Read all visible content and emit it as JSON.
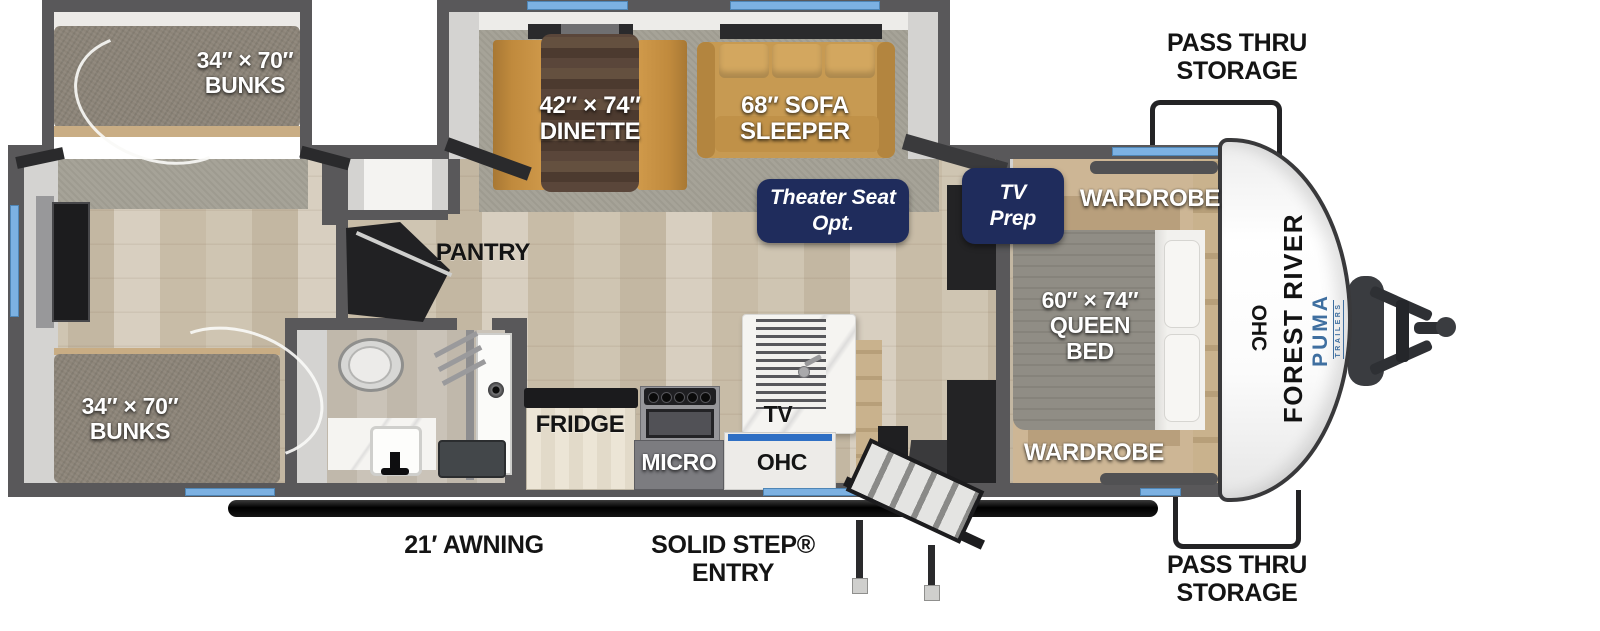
{
  "title": "Forest River Puma travel trailer floor plan",
  "colors": {
    "badge_navy": "#1f2c5c",
    "window_blue": "#7cb1e2",
    "puma_blue": "#3f6fa0",
    "wall_gray": "#59585a"
  },
  "exterior": {
    "pass_thru_top": {
      "line1": "PASS THRU",
      "line2": "STORAGE"
    },
    "pass_thru_bottom": {
      "line1": "PASS THRU",
      "line2": "STORAGE"
    },
    "awning": "21′ AWNING",
    "entry": {
      "line1": "SOLID STEP®",
      "line2": "ENTRY"
    },
    "brand_vertical": "FOREST RIVER",
    "model_vertical": "PUMA",
    "model_sub": "TRAILERS"
  },
  "rooms": {
    "bunk_top": {
      "size": "34″ × 70″",
      "name": "BUNKS"
    },
    "bunk_bottom": {
      "size": "34″ × 70″",
      "name": "BUNKS"
    },
    "dinette": {
      "size": "42″ × 74″",
      "name": "DINETTE"
    },
    "sofa": {
      "line1": "68″ SOFA",
      "line2": "SLEEPER"
    },
    "queen_bed": {
      "size": "60″ × 74″",
      "line2": "QUEEN",
      "line3": "BED"
    },
    "wardrobe_top": "WARDROBE",
    "wardrobe_bottom": "WARDROBE",
    "pantry": "PANTRY",
    "fridge": "FRIDGE",
    "micro": "MICRO",
    "tv": "TV",
    "ohc_kitchen": "OHC",
    "ohc_bedroom": "OHC"
  },
  "badges": {
    "theater": {
      "line1": "Theater Seat",
      "line2": "Opt."
    },
    "tv_prep": {
      "line1": "TV",
      "line2": "Prep"
    }
  }
}
